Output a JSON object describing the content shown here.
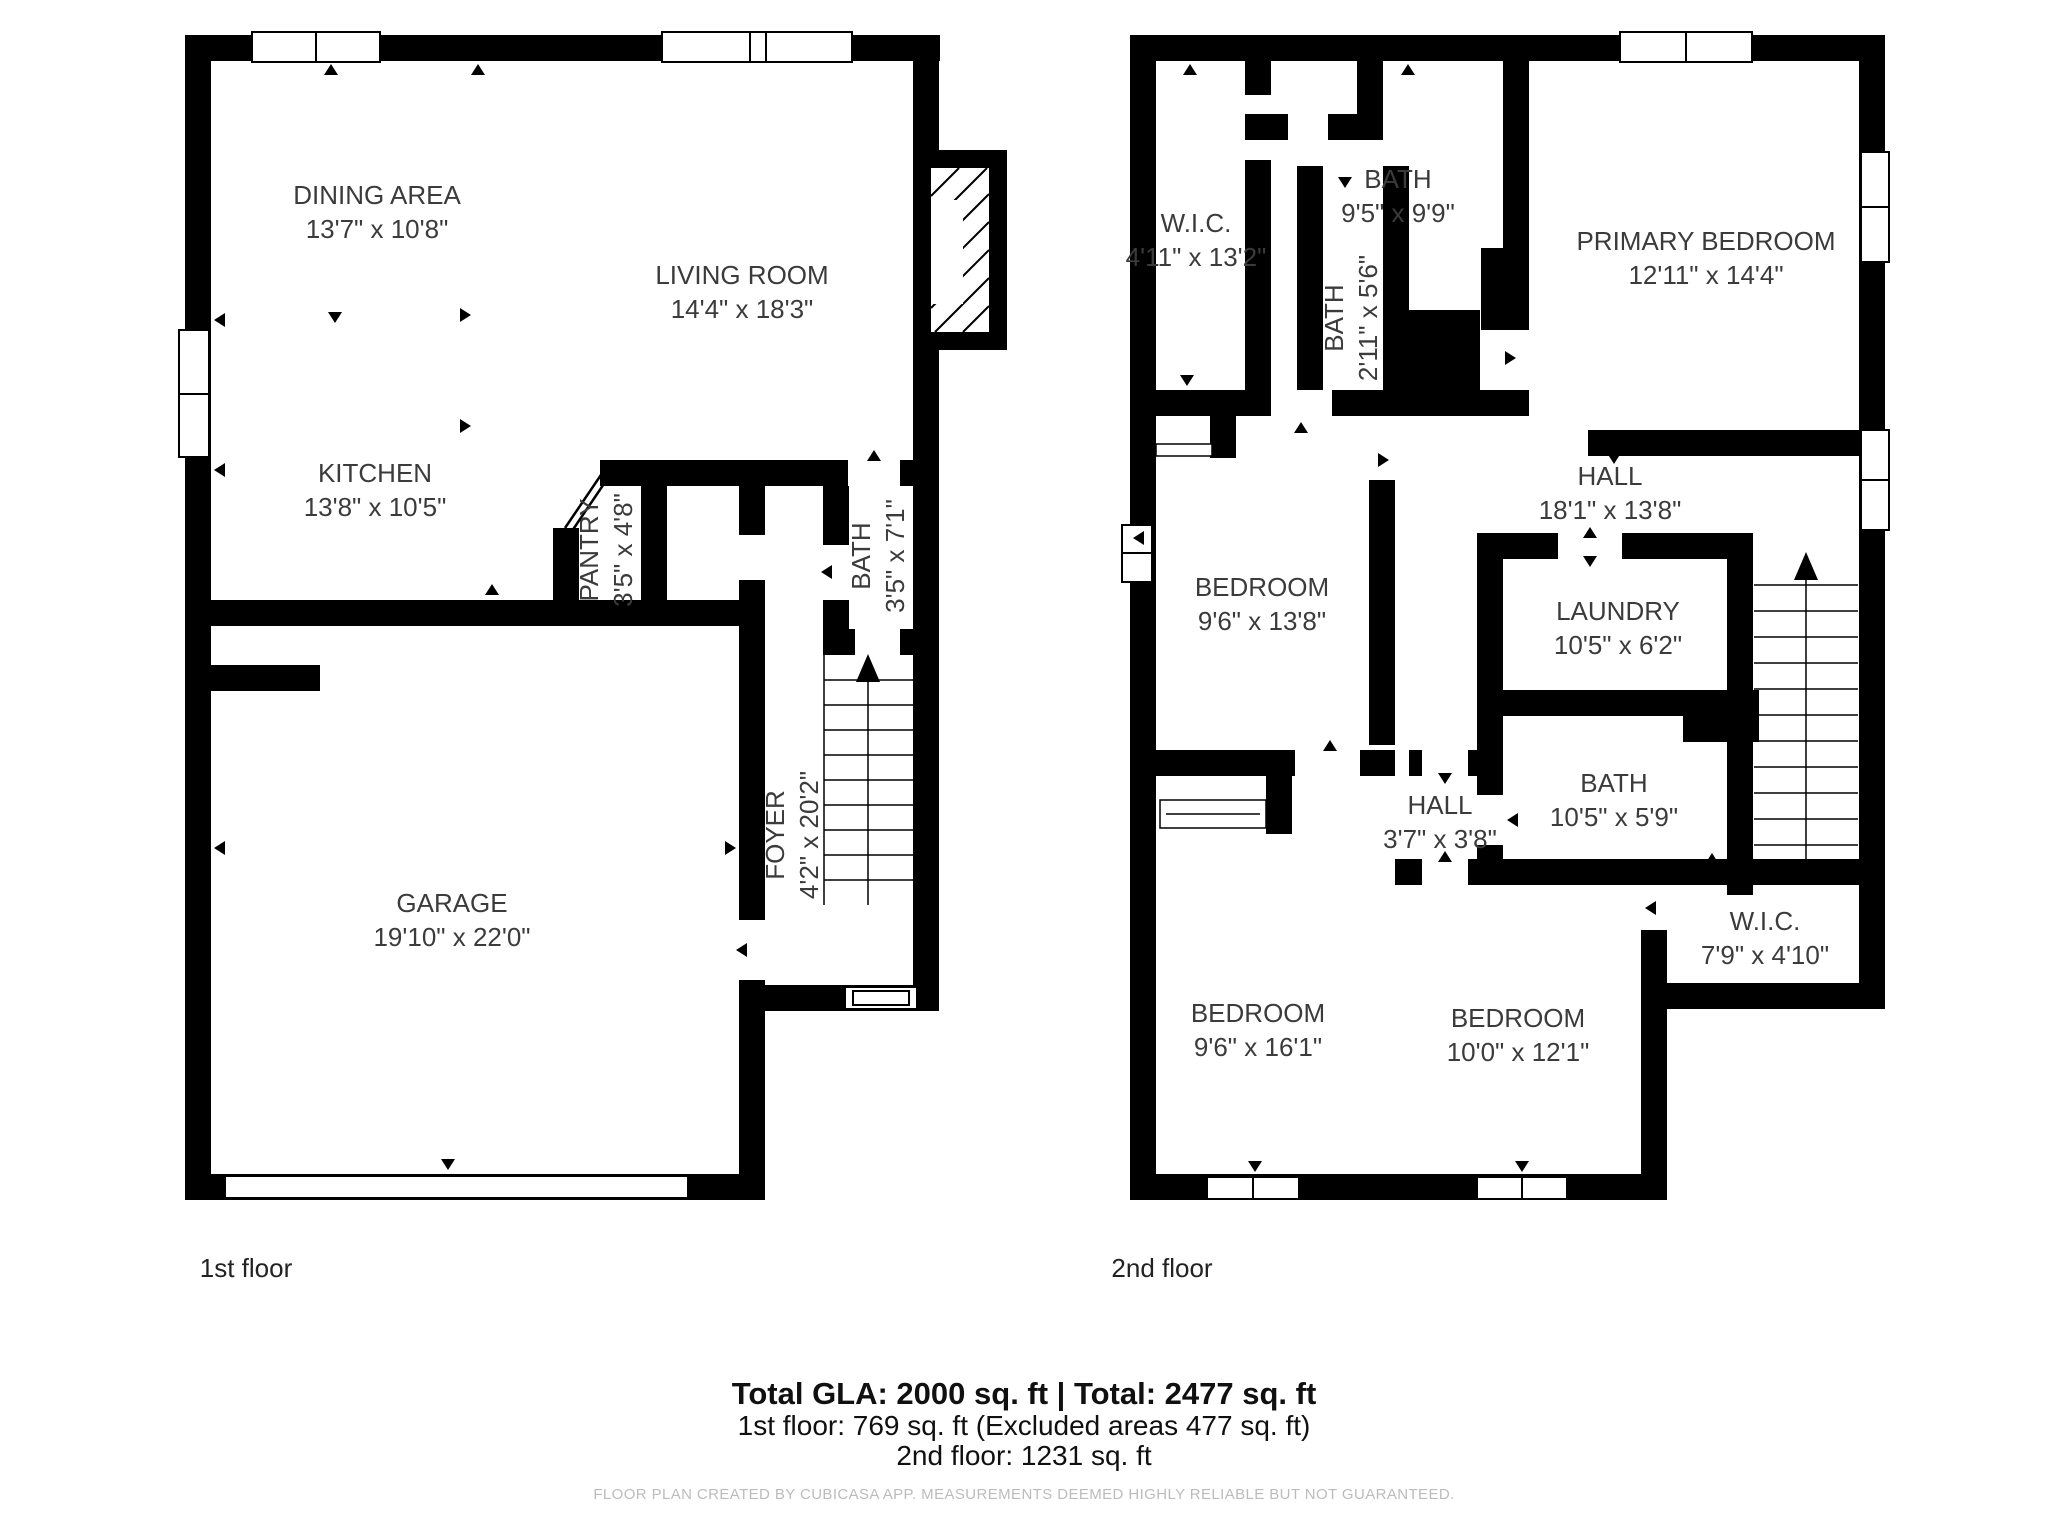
{
  "colors": {
    "background": "#ffffff",
    "walls": "#000000",
    "room_text": "#3b3b3b",
    "summary_text": "#101010",
    "footer_text": "#bcbcbc"
  },
  "floors": [
    {
      "caption": "1st floor",
      "rooms": [
        {
          "name": "DINING AREA",
          "dims": "13'7\" x 10'8\""
        },
        {
          "name": "LIVING ROOM",
          "dims": "14'4\" x 18'3\""
        },
        {
          "name": "KITCHEN",
          "dims": "13'8\" x 10'5\""
        },
        {
          "name": "PANTRY",
          "dims": "3'5\" x 4'8\""
        },
        {
          "name": "BATH",
          "dims": "3'5\" x 7'1\""
        },
        {
          "name": "FOYER",
          "dims": "4'2\" x 20'2\""
        },
        {
          "name": "GARAGE",
          "dims": "19'10\" x 22'0\""
        }
      ]
    },
    {
      "caption": "2nd floor",
      "rooms": [
        {
          "name": "W.I.C.",
          "dims": "4'11\" x 13'2\""
        },
        {
          "name": "BATH",
          "dims": "9'5\" x 9'9\""
        },
        {
          "name": "BATH",
          "dims": "2'11\" x 5'6\""
        },
        {
          "name": "PRIMARY BEDROOM",
          "dims": "12'11\" x 14'4\""
        },
        {
          "name": "HALL",
          "dims": "18'1\" x 13'8\""
        },
        {
          "name": "BEDROOM",
          "dims": "9'6\" x 13'8\""
        },
        {
          "name": "LAUNDRY",
          "dims": "10'5\" x 6'2\""
        },
        {
          "name": "BATH",
          "dims": "10'5\" x 5'9\""
        },
        {
          "name": "HALL",
          "dims": "3'7\" x 3'8\""
        },
        {
          "name": "W.I.C.",
          "dims": "7'9\" x 4'10\""
        },
        {
          "name": "BEDROOM",
          "dims": "9'6\" x 16'1\""
        },
        {
          "name": "BEDROOM",
          "dims": "10'0\" x 12'1\""
        }
      ]
    }
  ],
  "summary": {
    "line1": "Total GLA: 2000 sq. ft | Total: 2477 sq. ft",
    "line2": "1st floor: 769 sq. ft (Excluded areas 477 sq. ft)",
    "line3": "2nd floor: 1231 sq. ft"
  },
  "footer": "FLOOR PLAN CREATED BY CUBICASA APP. MEASUREMENTS DEEMED HIGHLY RELIABLE BUT NOT GUARANTEED."
}
